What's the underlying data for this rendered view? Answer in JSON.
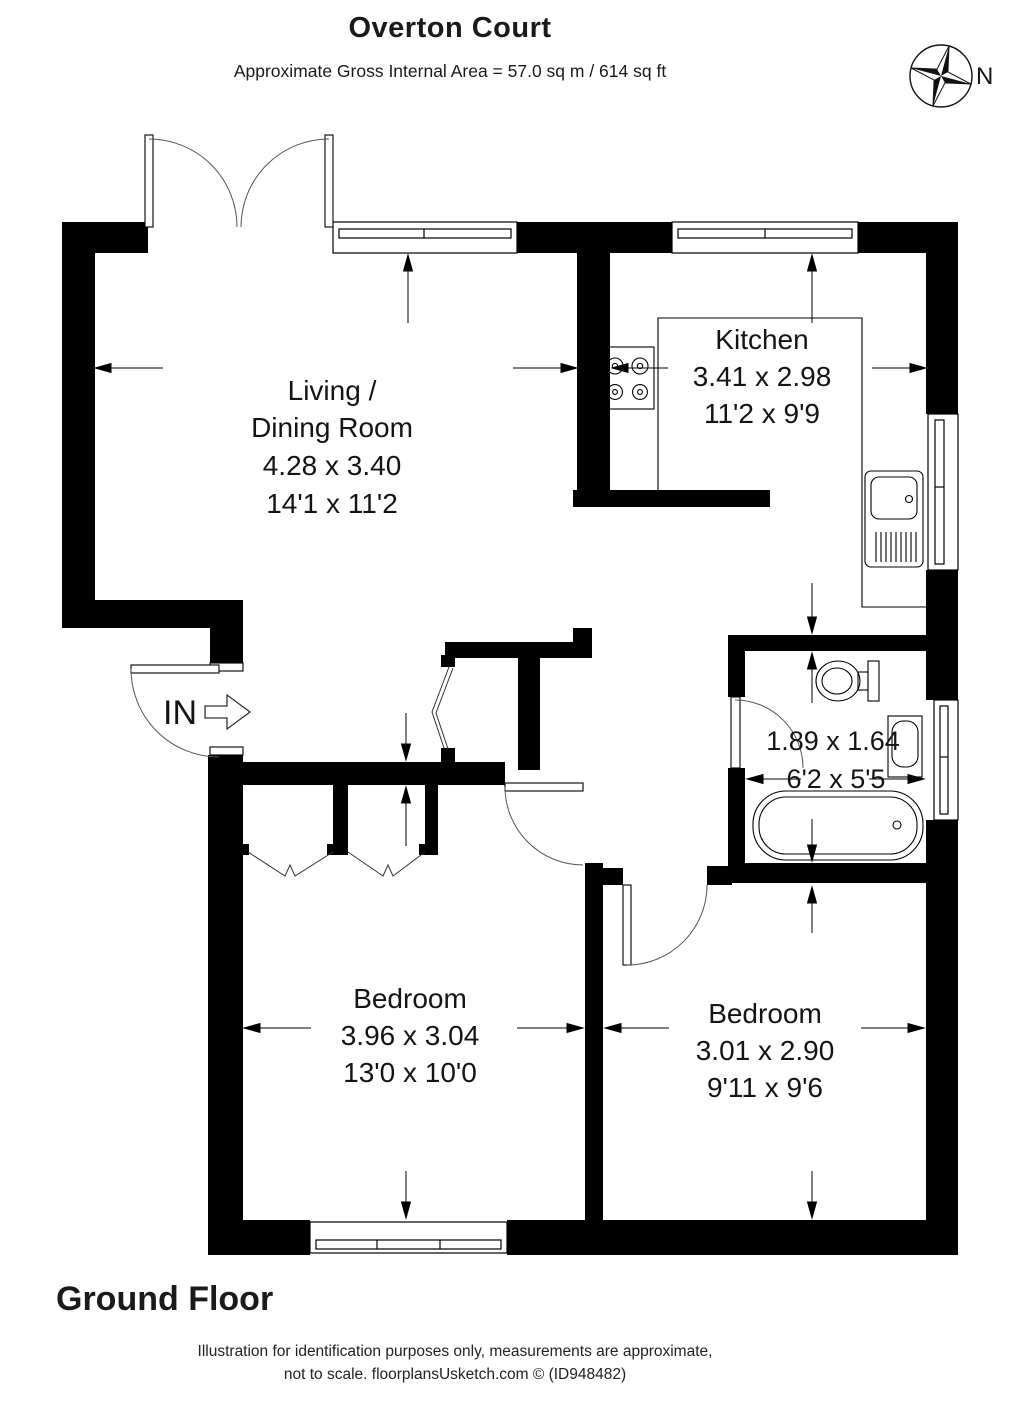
{
  "header": {
    "title": "Overton Court",
    "subtitle": "Approximate Gross Internal Area = 57.0 sq m / 614 sq ft"
  },
  "compass": {
    "label": "N"
  },
  "rooms": {
    "living": {
      "name_line1": "Living /",
      "name_line2": "Dining Room",
      "metric": "4.28 x 3.40",
      "imperial": "14'1 x 11'2"
    },
    "kitchen": {
      "name": "Kitchen",
      "metric": "3.41 x 2.98",
      "imperial": "11'2 x 9'9"
    },
    "bathroom": {
      "metric": "1.89 x 1.64",
      "imperial": "6'2 x 5'5"
    },
    "bedroom1": {
      "name": "Bedroom",
      "metric": "3.96 x 3.04",
      "imperial": "13'0 x 10'0"
    },
    "bedroom2": {
      "name": "Bedroom",
      "metric": "3.01 x 2.90",
      "imperial": "9'11 x 9'6"
    }
  },
  "entry": {
    "label": "IN"
  },
  "floor": {
    "label": "Ground Floor"
  },
  "footer": {
    "line1": "Illustration for identification purposes only, measurements are approximate,",
    "line2": "not to scale. floorplansUsketch.com © (ID948482)"
  },
  "colors": {
    "wall": "#000000",
    "text": "#141414",
    "background": "#ffffff"
  }
}
